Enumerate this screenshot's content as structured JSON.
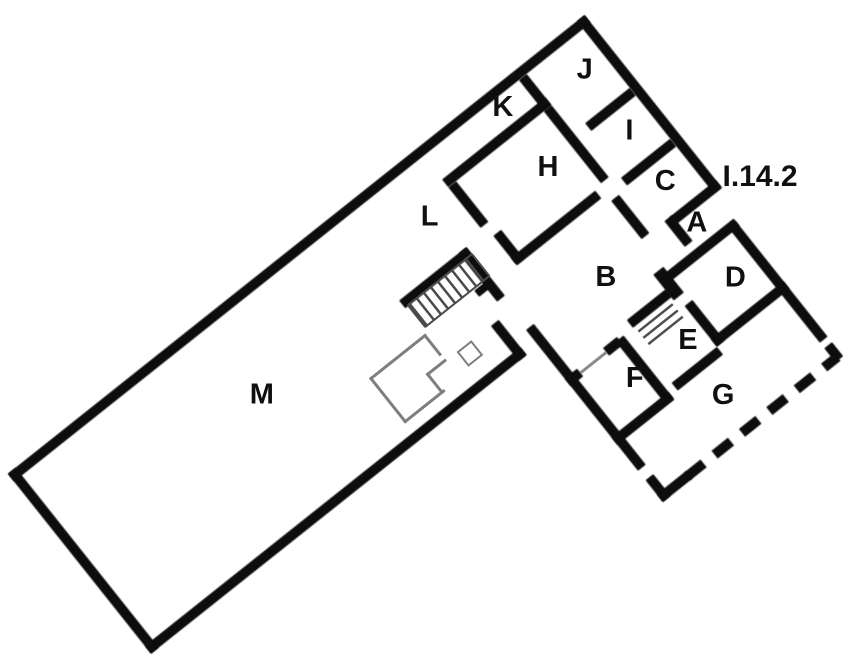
{
  "figure": {
    "type": "archaeological-floor-plan",
    "address_label": "I.14.2"
  },
  "plan": {
    "room_labels": [
      {
        "id": "M",
        "u": 246,
        "v": 101
      },
      {
        "id": "L",
        "u": 489,
        "v": 64
      },
      {
        "id": "K",
        "u": 614,
        "v": 25
      },
      {
        "id": "J",
        "u": 702,
        "v": 45
      },
      {
        "id": "I",
        "u": 700,
        "v": 118
      },
      {
        "id": "H",
        "u": 612,
        "v": 100
      },
      {
        "id": "C",
        "u": 695,
        "v": 184
      },
      {
        "id": "A",
        "u": 694,
        "v": 236
      },
      {
        "id": "B",
        "u": 589,
        "v": 222
      },
      {
        "id": "D",
        "u": 690,
        "v": 303
      },
      {
        "id": "E",
        "u": 614,
        "v": 322
      },
      {
        "id": "F",
        "u": 549,
        "v": 318
      },
      {
        "id": "G",
        "u": 607,
        "v": 388
      }
    ],
    "address": {
      "text": "I.14.2",
      "u": 766,
      "v": 256
    },
    "features": [
      {
        "name": "main-staircase"
      },
      {
        "name": "small-staircase"
      },
      {
        "name": "masonry-counter"
      },
      {
        "name": "dashed-reconstructed-wall"
      }
    ],
    "colors": {
      "wall": "#0d0d0d",
      "thin_feature": "#7e7e7e",
      "label": "#101010",
      "background": "#ffffff"
    }
  }
}
